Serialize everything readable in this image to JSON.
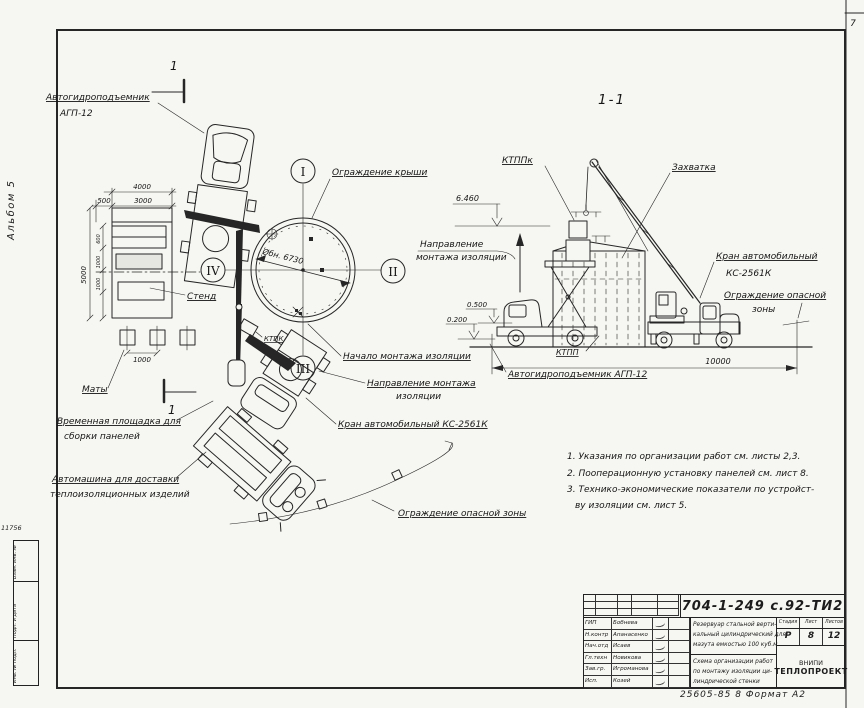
{
  "frame": {
    "corner_number": "7",
    "album_label": "Альбом 5",
    "inv_small_number": "11756",
    "stamp_cells": [
      "Взам. инв. №",
      "Подп. и дата",
      "Инв. № подл."
    ],
    "format_note": "25605-85   8   Формат А2"
  },
  "plan": {
    "section_cut_label": "1",
    "axis_marks": [
      "I",
      "II",
      "III",
      "IV"
    ],
    "labels": {
      "agp_line1": "Автогидроподъемник",
      "agp_line2": "АГП-12",
      "roof_guard": "Ограждение крыши",
      "stand": "Стенд",
      "mats": "Маты",
      "temp_platform_line1": "Временная площадка для",
      "temp_platform_line2": "сборки панелей",
      "delivery_truck_line1": "Автомашина для доставки",
      "delivery_truck_line2": "теплоизоляционных изделий",
      "insulation_start": "Начало монтажа изоляции",
      "insulation_dir_line1": "Направление монтажа",
      "insulation_dir_line2": "изоляции",
      "truck_crane": "Кран автомобильный  КС-2561К",
      "danger_zone": "Ограждение опасной зоны",
      "container": "КТПК",
      "tank_diameter": "Øбн. 6730"
    },
    "dimensions": {
      "stand_width": "4000",
      "stand_offset": "500",
      "stand_inner": "3000",
      "stand_height": "5000",
      "seg1": "600",
      "seg2": "1000",
      "seg3": "1000",
      "mats_spacing": "1000"
    }
  },
  "section": {
    "title": "1-1",
    "labels": {
      "ktppk": "КТППк",
      "zahvatka": "Захватка",
      "truck_crane_line1": "Кран автомобильный",
      "truck_crane_line2": "КС-2561К",
      "danger_zone_line1": "Ограждение опасной",
      "danger_zone_line2": "зоны",
      "ktpp": "КТПП",
      "agp": "Автогидроподъемник АГП-12",
      "dir_line1": "Направление",
      "dir_line2": "монтажа изоляции"
    },
    "elevations": {
      "top": "6.460",
      "mid": "0.500",
      "low": "0.200"
    },
    "overall_dim": "10000"
  },
  "notes": [
    "1. Указания по организации работ см. листы 2,3.",
    "2. Пооперационную установку панелей см. лист 8.",
    "3. Технико-экономические показатели по устройст-",
    "ву изоляции см. лист 5."
  ],
  "title_block": {
    "doc_number": "704-1-249 с.92-ТИ2",
    "sign_rows": [
      {
        "role": "ГИП",
        "name": "Бобнева"
      },
      {
        "role": "Н.контр",
        "name": "Апанасенко"
      },
      {
        "role": "Нач.отд",
        "name": "Исаев"
      },
      {
        "role": "Гл.техн",
        "name": "Новикова"
      },
      {
        "role": "Зав.гр.",
        "name": "Игроманова"
      },
      {
        "role": "Исп.",
        "name": "Козей"
      }
    ],
    "description_line1": "Резервуар стальной верти-",
    "description_line2": "кальный цилиндрический для",
    "description_line3": "мазута емкостью 100 куб.м",
    "subject_line1": "Схема организации работ",
    "subject_line2": "по монтажу изоляции ци-",
    "subject_line3": "линдрической стенки",
    "stage_headers": [
      "Стадия",
      "Лист",
      "Листов"
    ],
    "stage": "Р",
    "sheet": "8",
    "sheets": "12",
    "org_line1": "ВНИПИ",
    "org_line2": "ТЕПЛОПРОЕКТ"
  }
}
